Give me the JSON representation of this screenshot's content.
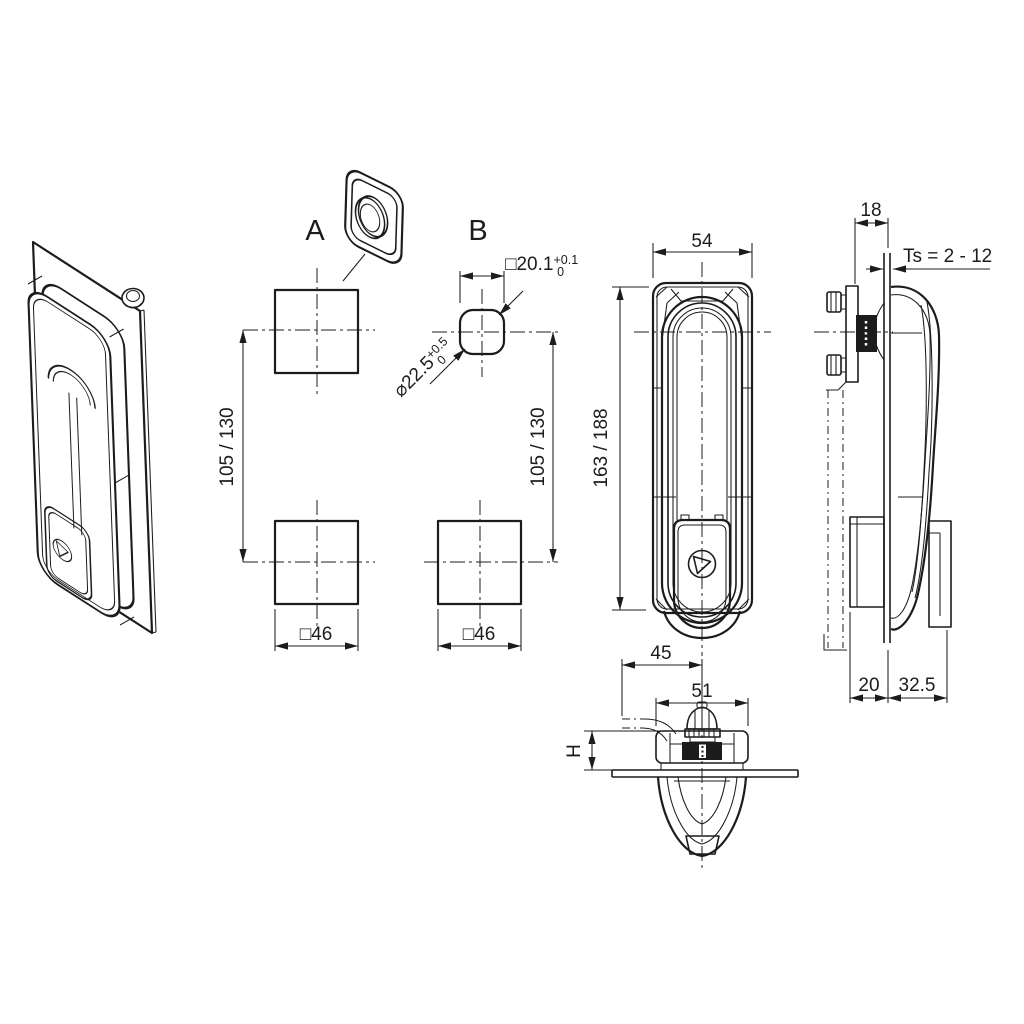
{
  "drawing": {
    "type": "engineering-drawing",
    "colors": {
      "line": "#1c1c1c",
      "background": "#ffffff"
    },
    "views": {
      "a": {
        "label": "A",
        "height_dim": "105 / 130",
        "square_dim": "□46"
      },
      "b": {
        "label": "B",
        "height_dim": "105 / 130",
        "square_dim": "□46",
        "cutout_square": {
          "value": "□20.1",
          "tol_plus": "+0.1",
          "tol_minus": "0"
        },
        "cutout_diameter": {
          "value": "⌀22.5",
          "tol_plus": "+0.5",
          "tol_minus": "0"
        }
      },
      "front": {
        "width_dim": "54",
        "height_dim": "163 / 188"
      },
      "side": {
        "grip_depth_dim": "18",
        "door_thickness_dim": "Ts = 2 - 12",
        "behind_door_dim": "20",
        "front_of_door_dim": "32.5"
      },
      "bottom": {
        "lever_dim": "45",
        "housing_width_dim": "51",
        "height_dim": "H"
      }
    }
  }
}
